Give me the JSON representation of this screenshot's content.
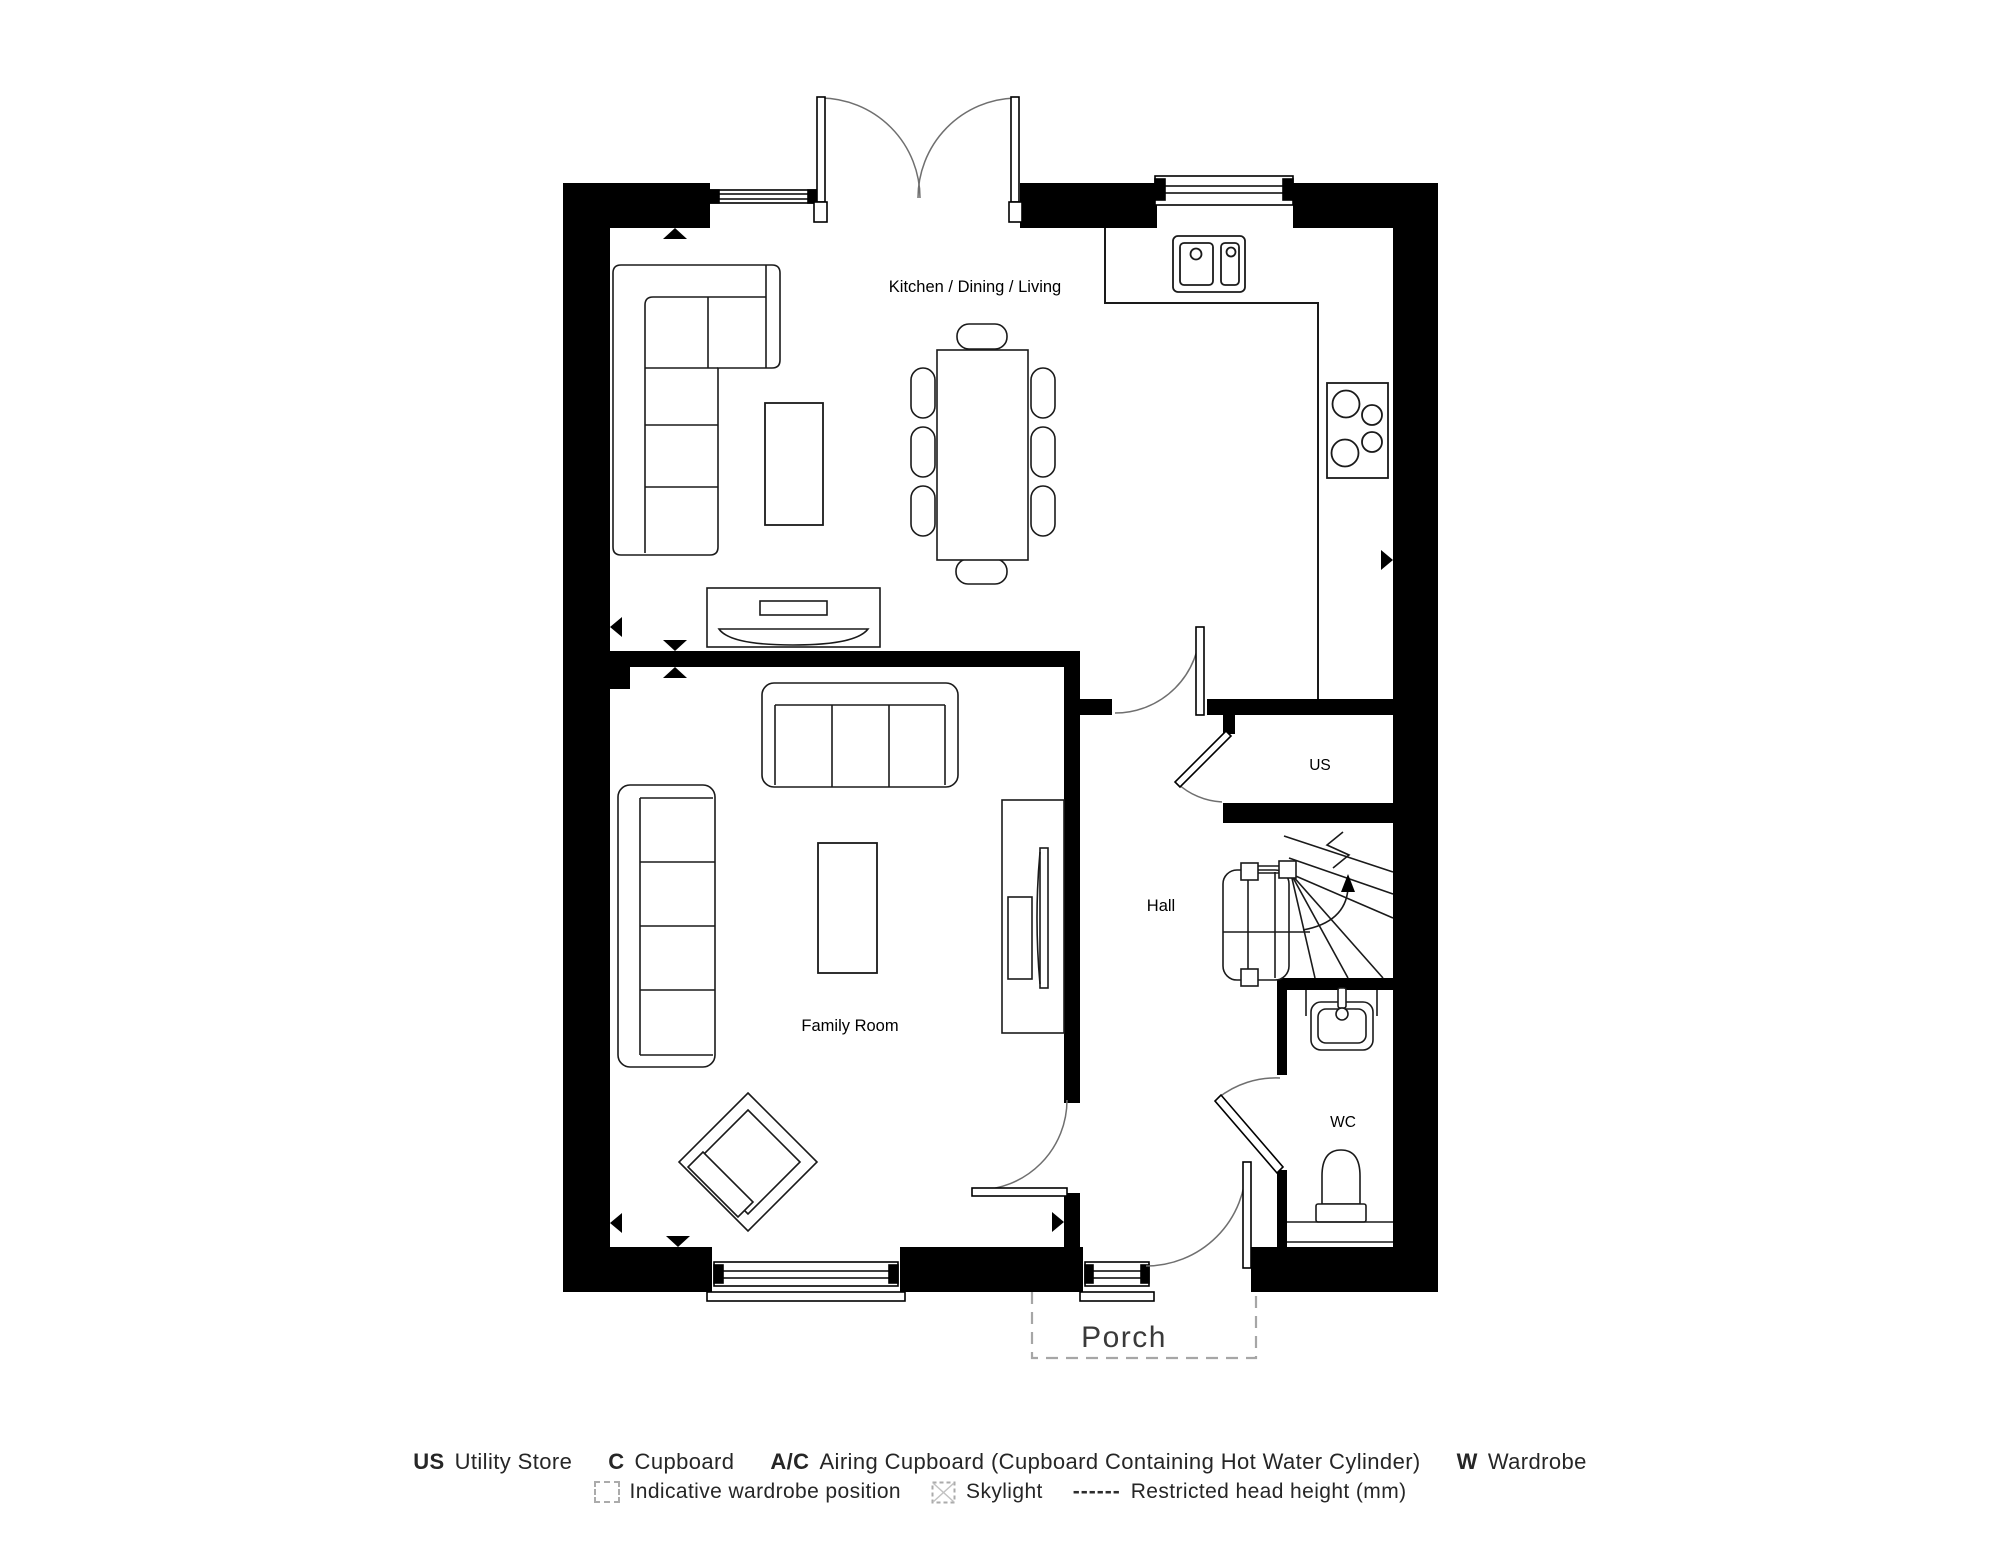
{
  "rooms": {
    "kitchen_dining_living": "Kitchen / Dining / Living",
    "family_room": "Family Room",
    "hall": "Hall",
    "utility_store": "US",
    "wc": "WC",
    "porch": "Porch"
  },
  "legend": {
    "abbreviations": [
      {
        "abbr": "US",
        "label": "Utility Store"
      },
      {
        "abbr": "C",
        "label": "Cupboard"
      },
      {
        "abbr": "A/C",
        "label": "Airing Cupboard (Cupboard Containing Hot Water Cylinder)"
      },
      {
        "abbr": "W",
        "label": "Wardrobe"
      }
    ],
    "symbols": {
      "wardrobe_position": "Indicative wardrobe position",
      "skylight": "Skylight",
      "restricted_dashes": "------",
      "restricted_head_height": "Restricted head height (mm)"
    }
  },
  "colors": {
    "background": "#ffffff",
    "walls": "#000000",
    "furniture_line": "#1a1a1a",
    "door_arc": "#6f6f6f",
    "legend_text": "#262626",
    "porch_text": "#3a3a3a",
    "dashed_gray": "#a6a6a6"
  }
}
